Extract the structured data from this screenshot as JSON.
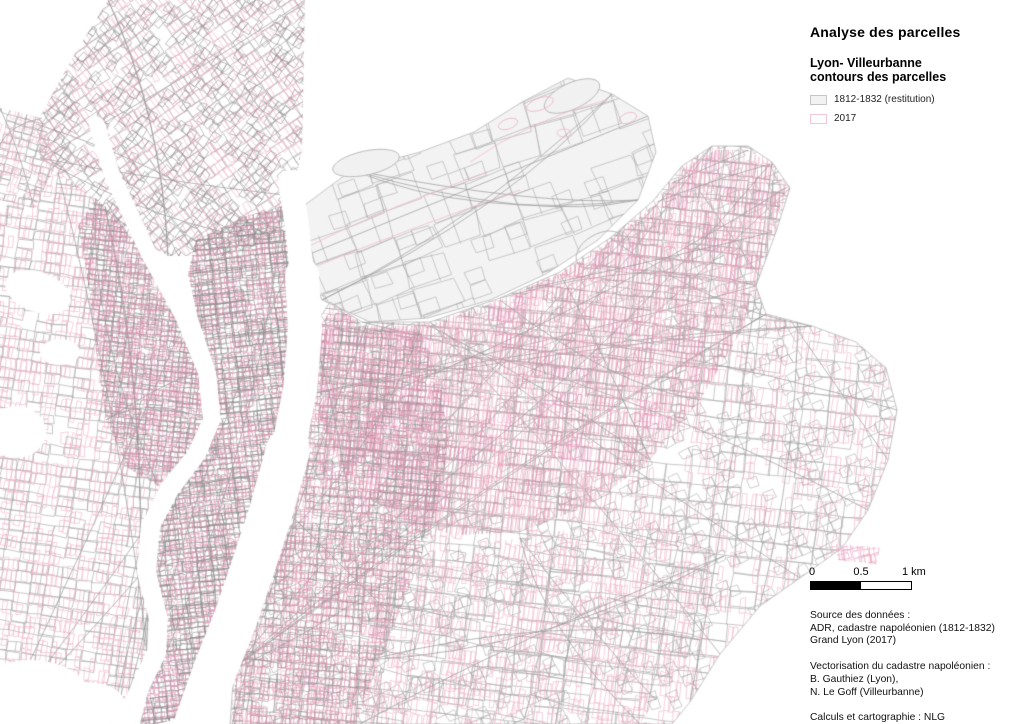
{
  "title": "Analyse des parcelles",
  "legend": {
    "heading_line1": "Lyon- Villeurbanne",
    "heading_line2": "contours des parcelles",
    "items": [
      {
        "label": "1812-1832 (restitution)",
        "swatch_fill": "#f2f2f2",
        "swatch_border": "#c6c6c6"
      },
      {
        "label": "2017",
        "swatch_fill": "#fffcfd",
        "swatch_border": "#f2c8d9"
      }
    ]
  },
  "scalebar": {
    "tick0": "0",
    "tick05": "0.5",
    "tick1": "1 km"
  },
  "credits": {
    "source_lines": [
      "Source des données :",
      "ADR, cadastre napoléonien (1812-1832)",
      "Grand Lyon (2017)"
    ],
    "vector_lines": [
      "Vectorisation du cadastre napoléonien :",
      "B. Gauthiez (Lyon),",
      "N. Le Goff (Villeurbanne)"
    ],
    "calc_lines": [
      "Calculs et cartographie : NLG",
      "Échelle : 1/25 000e"
    ]
  },
  "map": {
    "colors": {
      "parcel_1812": "#a8a8a8",
      "parcel_1812_dark": "#8d8d8d",
      "parcel_2017": "#f1b6cc",
      "parcel_2017_dark": "#e495b5",
      "restitution_fill": "#f3f3f3",
      "boundary": "#b2b2b2",
      "road": "#9c9c9c",
      "river": "#ffffff"
    }
  }
}
